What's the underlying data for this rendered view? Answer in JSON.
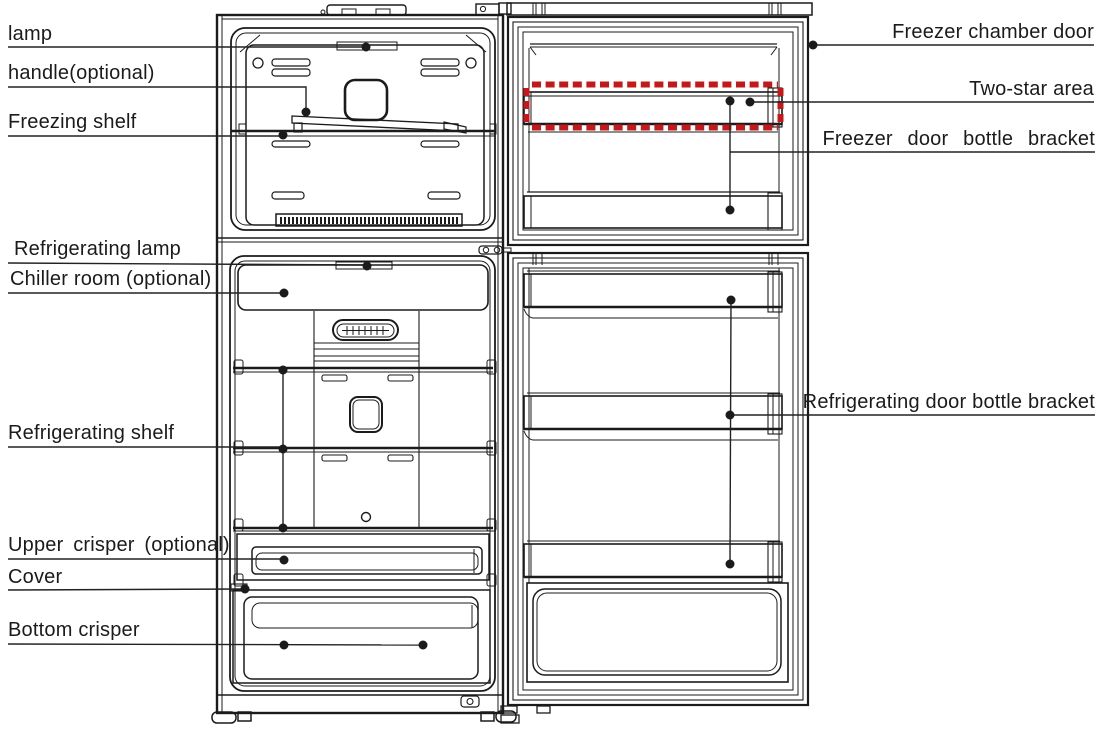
{
  "figure": {
    "kind": "refrigerator parts diagram",
    "views": [
      "cabinet interior (left)",
      "door interiors (right)"
    ]
  },
  "colors": {
    "line": "#1b1b1b",
    "two_star_marker": "#c4181b",
    "background": "#ffffff"
  },
  "callouts": {
    "left": [
      {
        "label": "lamp"
      },
      {
        "label": "handle(optional)"
      },
      {
        "label": "Freezing shelf"
      },
      {
        "label": "Refrigerating lamp"
      },
      {
        "label": "Chiller room (optional)"
      },
      {
        "label": "Refrigerating shelf"
      },
      {
        "label": "Upper crisper (optional)"
      },
      {
        "label": "Cover"
      },
      {
        "label": "Bottom crisper"
      }
    ],
    "right": [
      {
        "label": "Freezer chamber door"
      },
      {
        "label": "Two-star area"
      },
      {
        "label": "Freezer door bottle bracket"
      },
      {
        "label": "Refrigerating door bottle bracket"
      }
    ]
  }
}
